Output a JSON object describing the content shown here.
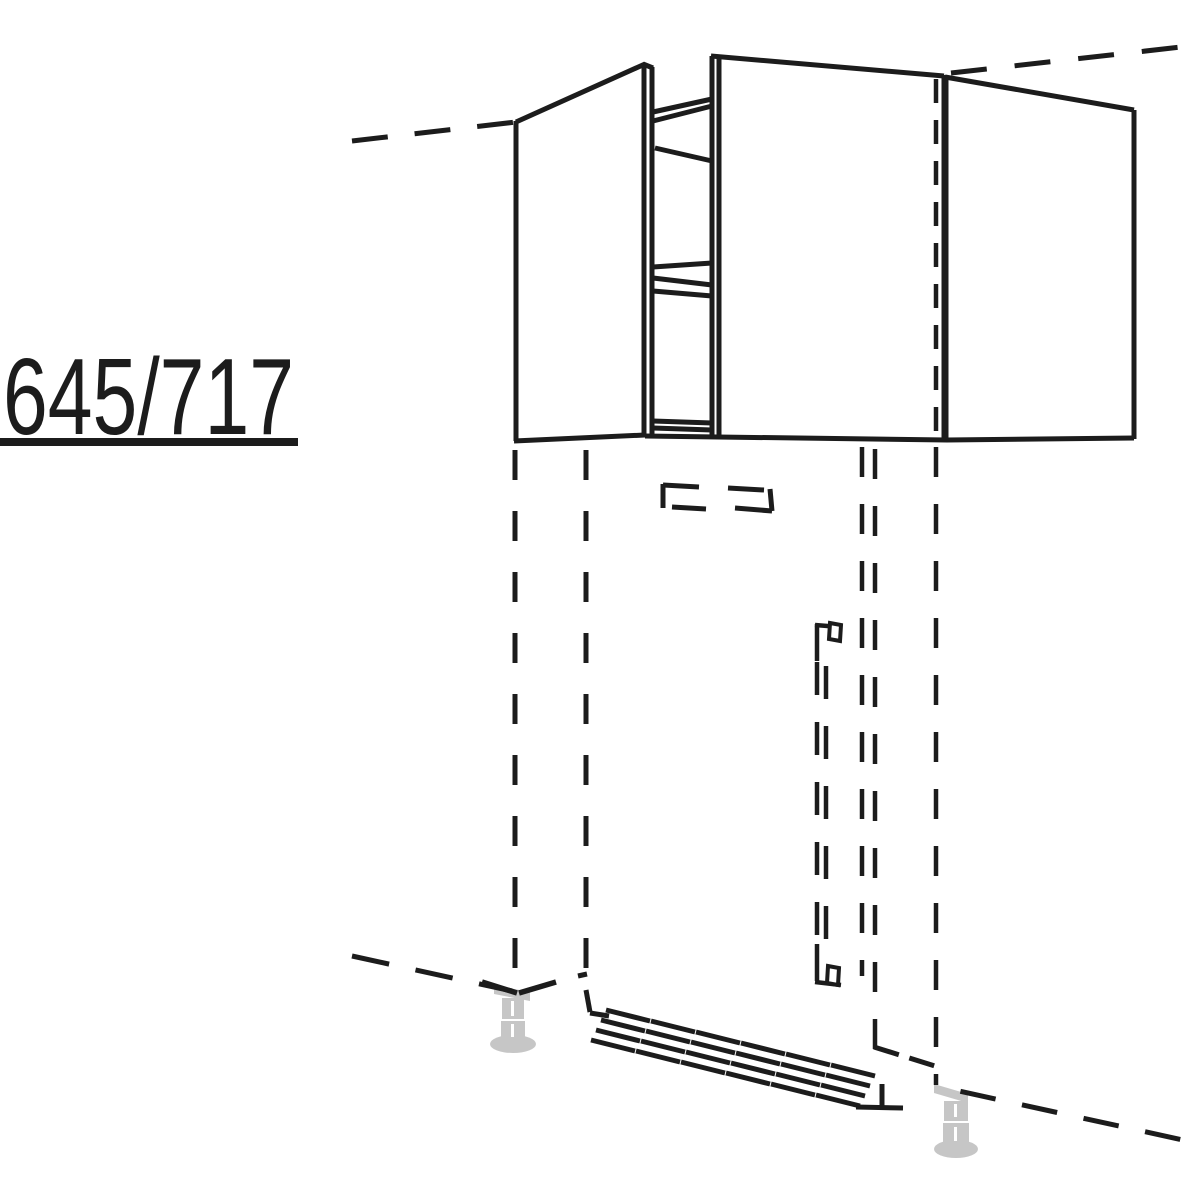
{
  "label": {
    "text": "645/717"
  },
  "colors": {
    "line": "#1c1c1c",
    "foot": "#c6c6c6",
    "background": "#ffffff"
  }
}
